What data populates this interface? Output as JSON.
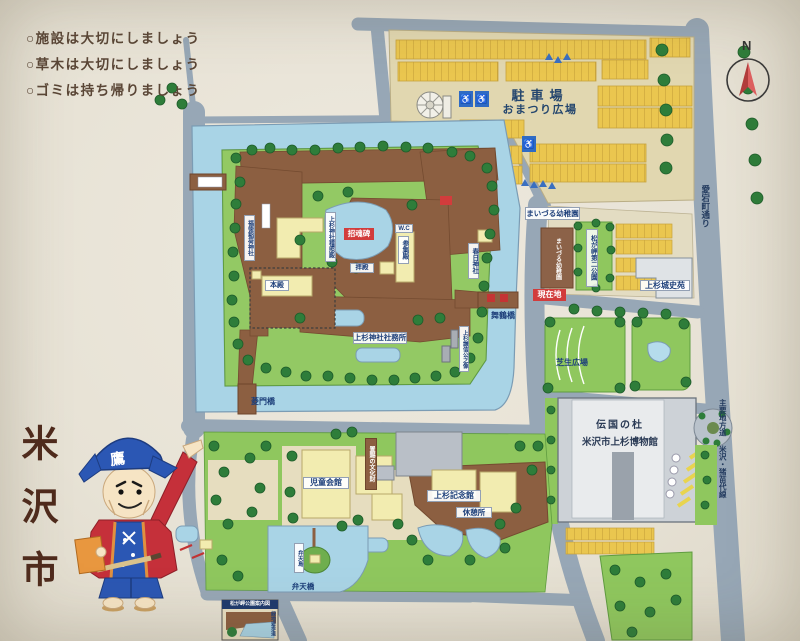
{
  "sign": {
    "rules": [
      "○施設は大切にしましょう",
      "○草木は大切にしましょう",
      "○ゴミは持ち帰りましょう"
    ],
    "city_name": "米沢市",
    "compass": "N",
    "mascot_hat_char": "鷹"
  },
  "map": {
    "parking": {
      "title": "駐車場",
      "subtitle": "おまつり広場",
      "accessible": "♿"
    },
    "streets": {
      "atago_dori": "愛宕町通り",
      "pref_road": "主要地方道 米沢・猪苗代線"
    },
    "shrine_island": {
      "fukutoku_inari": "福徳稲荷神社",
      "keishoden": "上杉神社稽照殿",
      "honden": "本殿",
      "shokonhi": "招魂碑",
      "haiden": "拝殿",
      "wc": "W.C",
      "sanshuden": "参集殿",
      "kasuga": "春日神社",
      "shamusho": "上杉神社社務所",
      "kenshin_statue": "上杉謙信公之像",
      "maizuru_bridge": "舞鶴橋",
      "hishimon_bridge": "菱門橋"
    },
    "east_blocks": {
      "you_are_here": "現在地",
      "kindergarten": "まいづる幼稚園",
      "second_park": "松が岬第二公園",
      "joshien": "上杉城史苑",
      "lawn": "芝生広場"
    },
    "museum": {
      "name1": "伝国の杜",
      "name2": "米沢市上杉博物館"
    },
    "south_blocks": {
      "children_hall": "児童会館",
      "okitama_bunkazai": "置賜の文化財",
      "kinenkan": "上杉記念館",
      "rest": "休憩所",
      "benten_bridge": "弁天橋",
      "benten_island": "弁天島",
      "inset_title": "松が岬公園案内図",
      "inset_side": "緑地遊歩道"
    }
  }
}
